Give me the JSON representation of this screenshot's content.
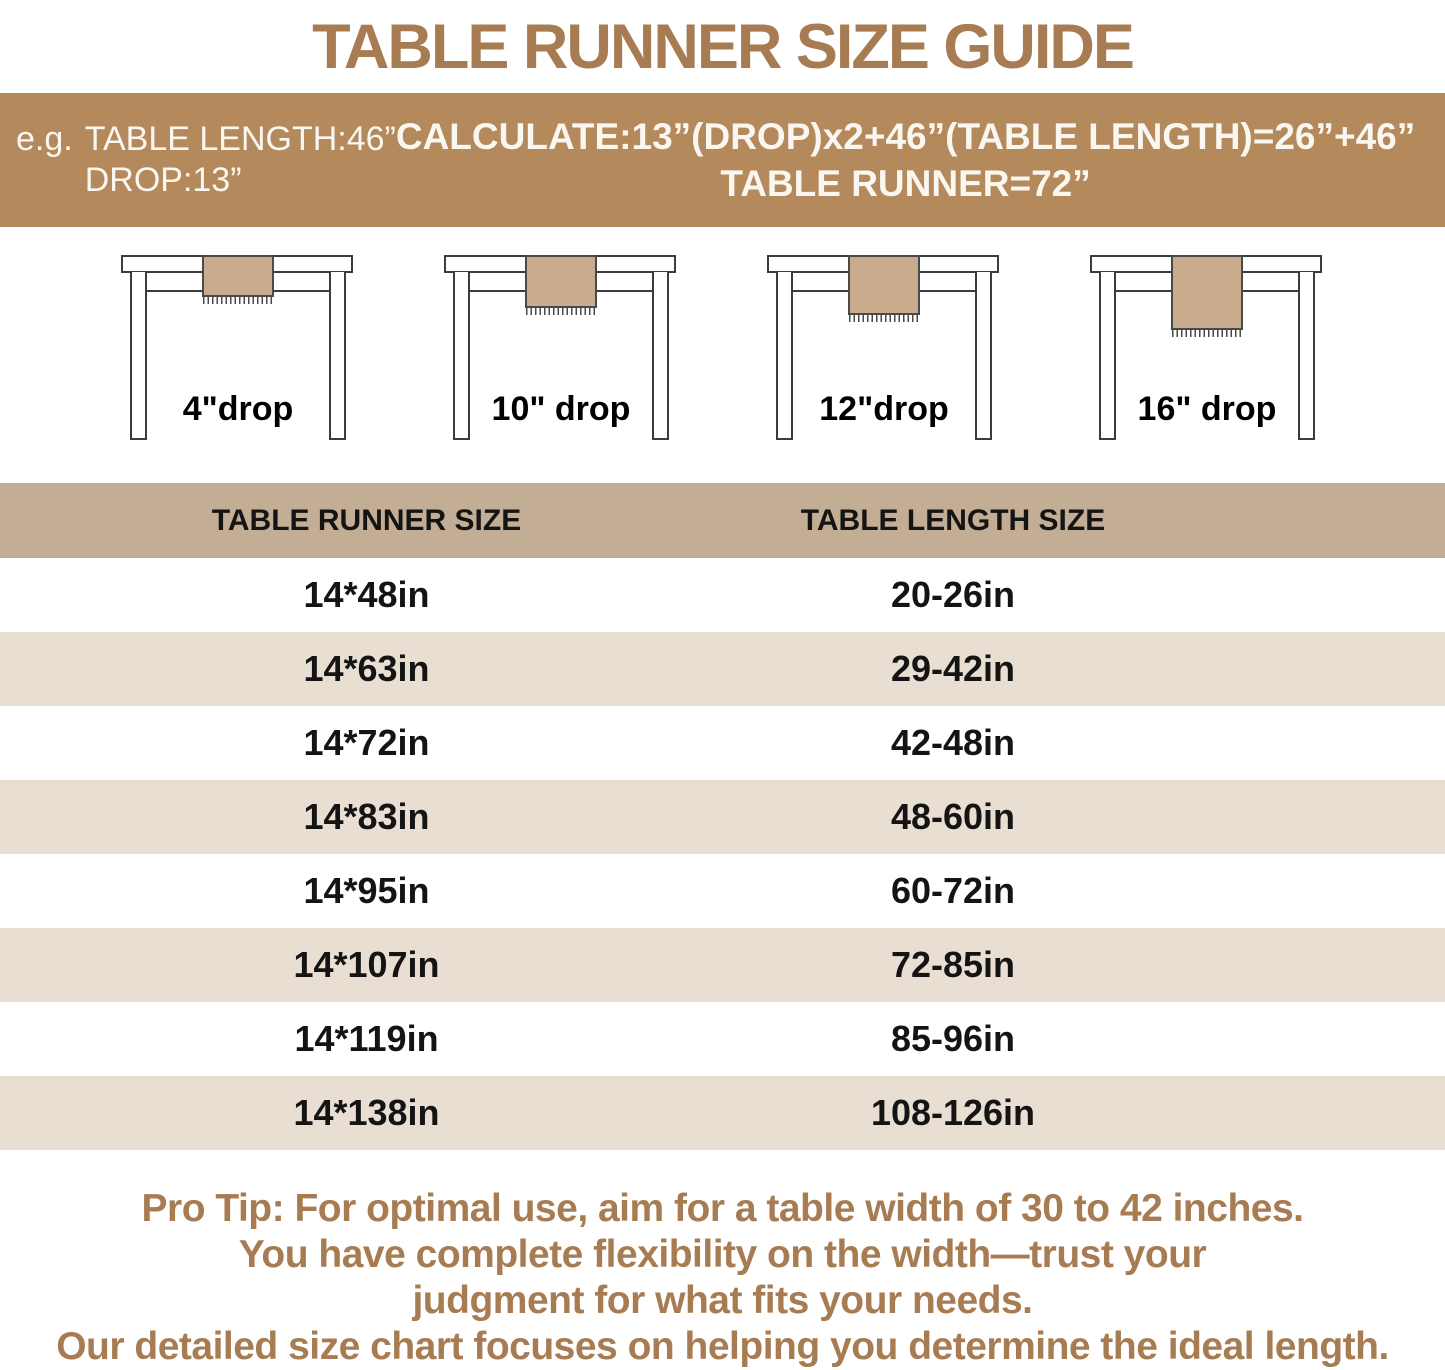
{
  "title": "TABLE RUNNER SIZE GUIDE",
  "banner": {
    "example_prefix": "e.g.",
    "example_line1": "TABLE LENGTH:46”",
    "example_line2": "DROP:13”",
    "calc_line1": "CALCULATE:13”(DROP)x2+46”(TABLE LENGTH)=26”+46”",
    "calc_line2": "TABLE RUNNER=72”"
  },
  "diagrams": [
    {
      "drop_label": "4\"drop"
    },
    {
      "drop_label": "10\" drop"
    },
    {
      "drop_label": "12\"drop"
    },
    {
      "drop_label": "16\" drop"
    }
  ],
  "size_chart": {
    "columns": [
      "TABLE RUNNER SIZE",
      "TABLE LENGTH SIZE"
    ],
    "rows": [
      [
        "14*48in",
        "20-26in"
      ],
      [
        "14*63in",
        "29-42in"
      ],
      [
        "14*72in",
        "42-48in"
      ],
      [
        "14*83in",
        "48-60in"
      ],
      [
        "14*95in",
        "60-72in"
      ],
      [
        "14*107in",
        "72-85in"
      ],
      [
        "14*119in",
        "85-96in"
      ],
      [
        "14*138in",
        "108-126in"
      ]
    ]
  },
  "pro_tip": {
    "lines": [
      "Pro Tip: For optimal use, aim for a table width of 30 to 42 inches.",
      "You have complete flexibility on the width—trust your",
      "judgment for what fits your needs.",
      "Our detailed size chart focuses on helping you determine the ideal length."
    ]
  },
  "colors": {
    "title_brown": "#A87C52",
    "banner_bg": "#B4895C",
    "banner_text": "#FAF6F0",
    "header_bg": "#C3AD94",
    "row_alt_bg": "#E8DED2",
    "row_white": "#FFFFFF",
    "runner_fill": "#C9AC8E",
    "line_color": "#3C3C3C",
    "text_dark": "#141414"
  }
}
